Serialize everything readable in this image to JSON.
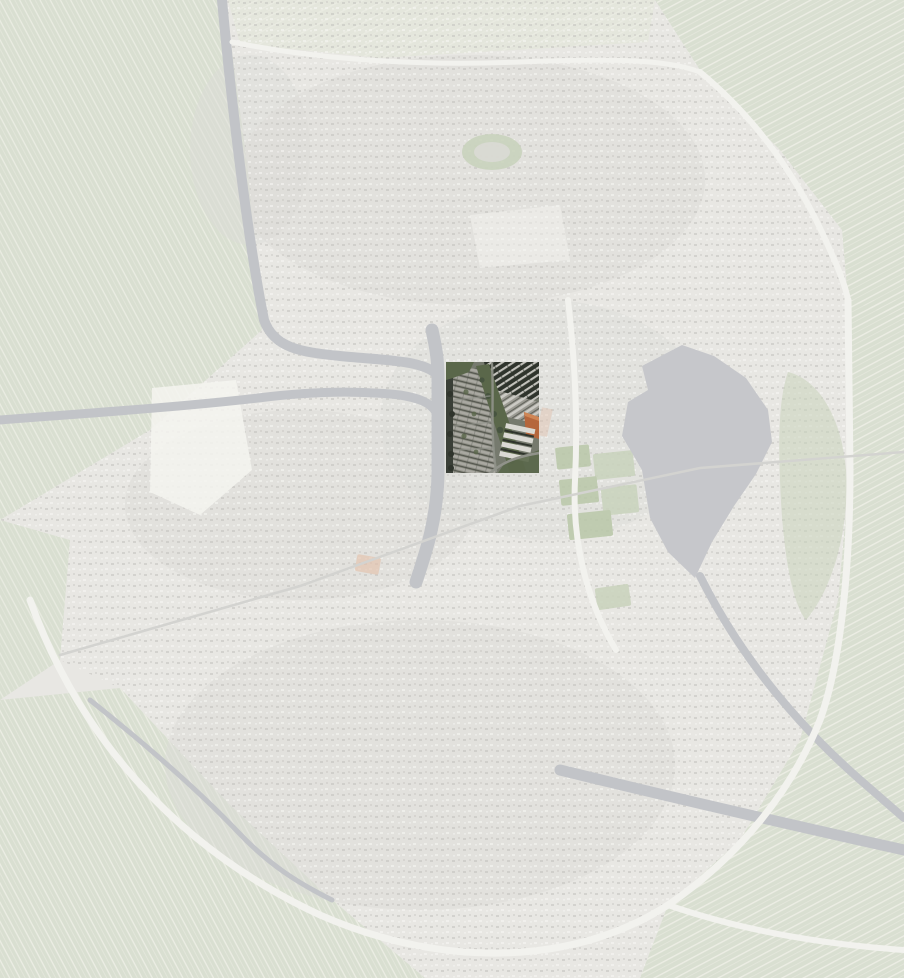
{
  "viewer": {
    "width": 904,
    "height": 978
  },
  "highlight": {
    "x": 446,
    "y": 362,
    "width": 93,
    "height": 111,
    "svg_transform": "translate(446 362)"
  },
  "colors": {
    "base": "#e8e7e3",
    "field": "#d9dfd1",
    "field_pale": "#e4e6dc",
    "stripe_light": "#ecede4",
    "speck_dark": "#c2c1bd",
    "speck_light": "#f8f8f5",
    "town_shade": "#dcdbd7",
    "white_patch": "#f4f4f0",
    "park_green": "#c9d3bc",
    "court_green": "#b9c7a8",
    "salmon": "#e3c2ac",
    "lake": "#c6c7cb",
    "water": "#c2c4c8",
    "road": "#f2f2ee",
    "road_minor": "#ececе8",
    "rail": "#d3d3d0",
    "tile_base": "#767a6e",
    "tile_dark": "#3a3f37",
    "tile_dark2": "#2f342c",
    "tile_green": "#5a674a",
    "tile_green_dark": "#475440",
    "tile_row_mid": "#8c8d83",
    "tile_row_light": "#a9a8a1",
    "tile_row_dark": "#4e5048",
    "tile_row_mid2": "#9b9a92",
    "tile_row_light2": "#cbcac4",
    "tile_top_light": "#c3c2bc",
    "tile_orange": "#b5663c",
    "tile_orange_light": "#d18a58",
    "tile_white": "#dad9d3",
    "tile_road": "#90928a"
  }
}
